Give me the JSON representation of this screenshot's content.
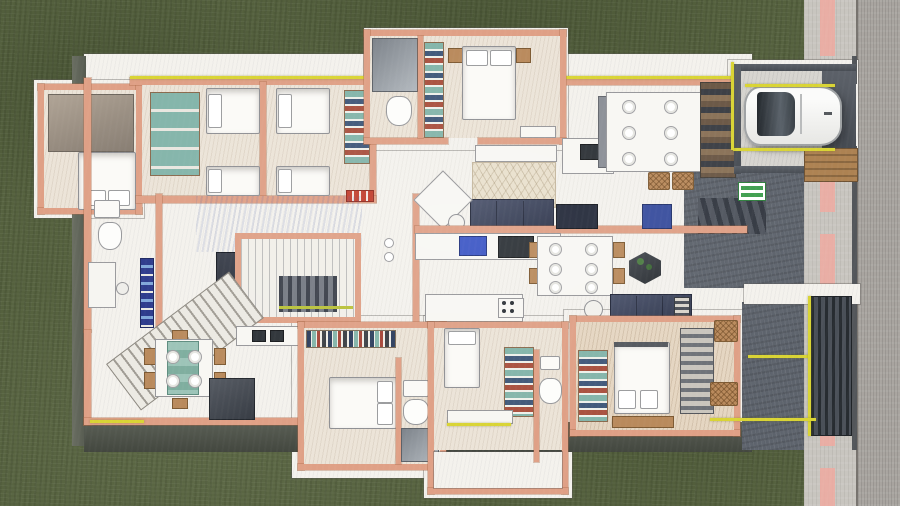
{
  "image": {
    "kind": "architectural floor plan rendering",
    "style": "hand-drawn colored-pencil top-down cutaway of a single-storey residence",
    "width_px": 900,
    "height_px": 506
  },
  "palette": {
    "grass": "#55613e",
    "sidewalk": "#c8c5bf",
    "asphalt": "#a8a49f",
    "road_marking": "#efaaa0",
    "slab": "#f4f2ed",
    "floor": "#ece4d8",
    "floor_tan": "#e5d6c2",
    "courtyard": "#5d636c",
    "wall": "#dfa086",
    "wall_edge": "#bd7b5c",
    "navy": "#3f4658",
    "tv": "#262c3c",
    "blue": "#3a4f9e",
    "sink_blue": "#3d57c5",
    "teal": "#84b5aa",
    "wood": "#b98a5c",
    "yellow": "#d9d434",
    "green_line": "#b9c23a",
    "sign_green": "#3f9e4f",
    "bed": "#fbfaf7",
    "outline": "#8f9094"
  },
  "site": {
    "lawn": "dark green textured lawn wrapping north, west and south of the plot",
    "street": {
      "position": "right edge, full height",
      "sidewalk": "light concrete strip",
      "marking": "pink dashed line running vertically",
      "roadway": "darker asphalt at far right"
    }
  },
  "residence": {
    "outdoor": [
      {
        "name": "carport",
        "contains": [
          "white car parked facing west",
          "yellow bay outline",
          "timber deck strip"
        ]
      },
      {
        "name": "entry-courtyard",
        "contains": [
          "dark concrete floor",
          "ramp strips",
          "green exit mat",
          "walkway to street"
        ]
      },
      {
        "name": "side-patio",
        "contains": [
          "dark slatted louver screen",
          "yellow glazing frame"
        ]
      },
      {
        "name": "south-terrace",
        "contains": [
          "dark shadow band along slab edge"
        ]
      }
    ],
    "rooms": [
      {
        "name": "bedroom-nw",
        "contains": [
          "double bed with two pillows",
          "wardrobe mass"
        ]
      },
      {
        "name": "kids-bedroom-a",
        "contains": [
          "two single beds",
          "teal sliding-door wardrobe"
        ]
      },
      {
        "name": "kids-bedroom-b",
        "contains": [
          "two single beds",
          "teal shelf wardrobe"
        ]
      },
      {
        "name": "master-bedroom",
        "contains": [
          "double bed with two pillows",
          "two wood nightstands",
          "colorful wardrobe column",
          "bench"
        ]
      },
      {
        "name": "master-ensuite",
        "contains": [
          "glass shower",
          "toilet"
        ]
      },
      {
        "name": "west-bathroom",
        "contains": [
          "sink",
          "toilet",
          "navy book ledge"
        ]
      },
      {
        "name": "study-nook",
        "contains": [
          "desk",
          "stool"
        ]
      },
      {
        "name": "living-room",
        "contains": [
          "navy three-seat sofa",
          "leaf-pattern rug",
          "white console",
          "diagonal armchair",
          "round side table",
          "wall tv panel",
          "blue wall oven"
        ]
      },
      {
        "name": "kitchen",
        "contains": [
          "counter with blue sink",
          "dark cooktop",
          "island with knob panel"
        ]
      },
      {
        "name": "north-dining",
        "contains": [
          "white table with six place settings",
          "two gray benches",
          "two rattan chairs",
          "kitchenette",
          "pantry shelving"
        ]
      },
      {
        "name": "stair-void",
        "contains": [
          "glass balustrade",
          "descending treads",
          "green-yellow glass edge"
        ]
      },
      {
        "name": "family-dining",
        "contains": [
          "table with teal runner and four plates",
          "wood chairs",
          "dark island cabinet",
          "staircase"
        ]
      },
      {
        "name": "bedroom-sw",
        "contains": [
          "book spine shelf band",
          "double bed",
          "ensuite with sink, toilet, shower"
        ]
      },
      {
        "name": "dressing-room",
        "contains": [
          "daybed",
          "colorful folded-clothes shelf",
          "bench with yellow edge"
        ]
      },
      {
        "name": "center-bathroom",
        "contains": [
          "toilet",
          "sink"
        ]
      },
      {
        "name": "bedroom-se",
        "contains": [
          "double bed with pillows at foot",
          "teal wardrobe",
          "gray shelf wardrobe",
          "two rattan chairs",
          "navy sofa with striped cushion",
          "round table"
        ]
      }
    ],
    "accents": [
      "yellow glazing lines along north wall, carport bay, courtyard frames and benches",
      "teal and navy folded clothes in open wardrobes",
      "bright blue kitchen sink and wall oven",
      "red striped doormat in hallway"
    ]
  }
}
